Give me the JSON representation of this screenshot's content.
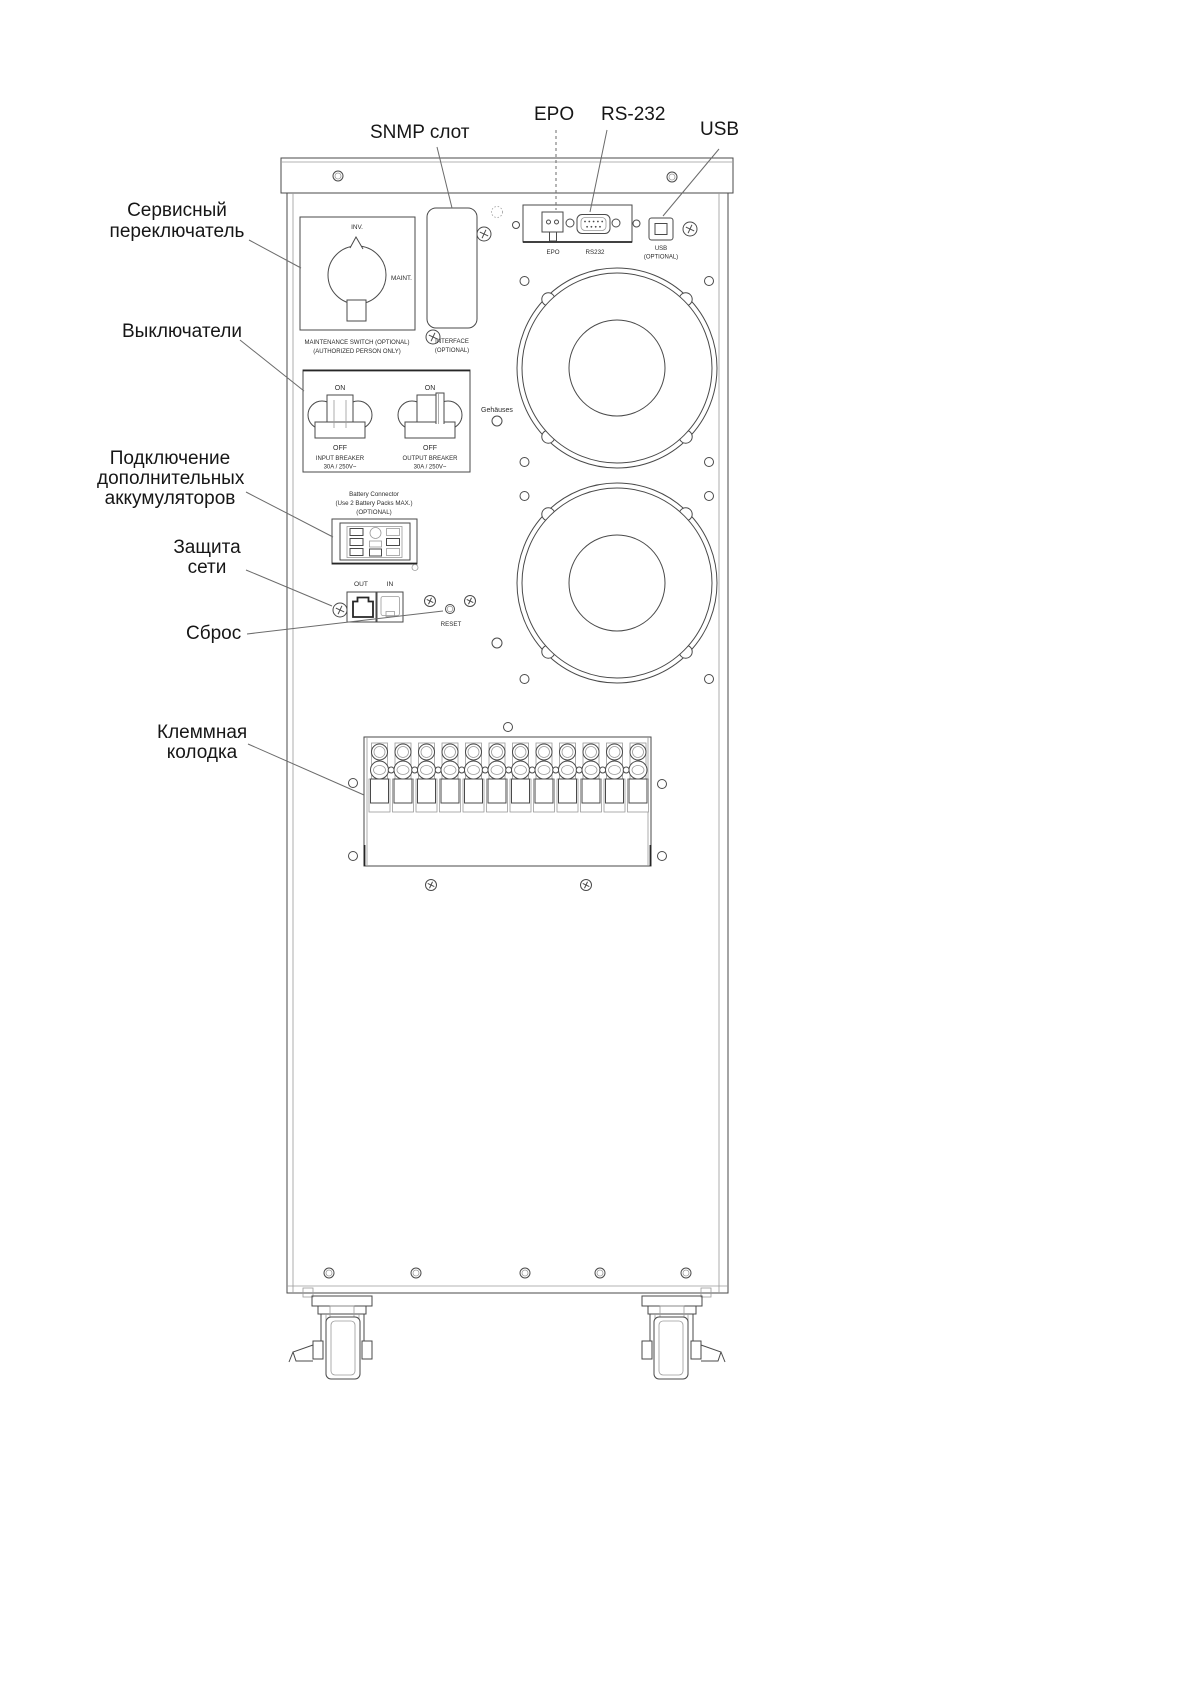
{
  "callouts": {
    "snmp_slot": "SNMP слот",
    "epo": "EPO",
    "rs232": "RS-232",
    "usb": "USB",
    "service_switch": [
      "Сервисный",
      "переключатель"
    ],
    "breakers": "Выключатели",
    "battery": [
      "Подключение",
      "дополнительных",
      "аккумуляторов"
    ],
    "network": [
      "Защита",
      "сети"
    ],
    "reset": "Сброс",
    "terminal": [
      "Клеммная",
      "колодка"
    ]
  },
  "panel": {
    "maintenance_switch": {
      "inv": "INV.",
      "maint": "MAINT.",
      "line1": "MAINTENANCE SWITCH  (OPTIONAL)",
      "line2": "(AUTHORIZED PERSON ONLY)"
    },
    "interface_cover": {
      "line1": "INTERFACE",
      "line2": "(OPTIONAL)"
    },
    "ports": {
      "epo": "EPO",
      "rs232": "RS232",
      "usb": "USB",
      "usb_note": "(OPTIONAL)"
    },
    "breaker_panel": {
      "on": "ON",
      "off": "OFF",
      "input1": "INPUT BREAKER",
      "input2": "30A / 250V~",
      "output1": "OUTPUT BREAKER",
      "output2": "30A / 250V~"
    },
    "battery_connector": {
      "line1": "Battery Connector",
      "line2": "(Use 2 Battery Packs MAX.)",
      "line3": "(OPTIONAL)"
    },
    "network": {
      "out": "OUT",
      "in": "IN",
      "reset": "RESET"
    },
    "stray": {
      "gehauses": "Gehäuses"
    }
  }
}
